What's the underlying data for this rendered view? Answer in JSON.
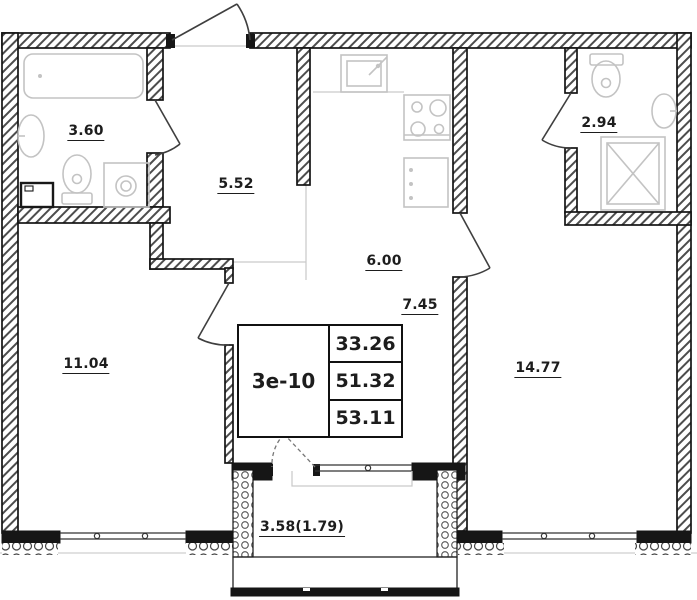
{
  "title": "Apartment floor plan",
  "unit": {
    "code": "3е-10",
    "living_area": "33.26",
    "total_area": "51.32",
    "total_area_with_balcony": "53.11"
  },
  "rooms": {
    "bathroom_top_left": {
      "area": "3.60"
    },
    "hallway": {
      "area": "5.52"
    },
    "bathroom_top_right": {
      "area": "2.94"
    },
    "kitchen": {
      "area": "6.00"
    },
    "corridor": {
      "area": "7.45"
    },
    "room_left": {
      "area": "11.04"
    },
    "room_right": {
      "area": "14.77"
    },
    "balcony": {
      "area": "3.58(1.79)"
    }
  },
  "fixtures": {
    "bathroom_top_left": [
      "bathtub-icon",
      "washbasin-icon",
      "toilet-icon",
      "washing-machine-icon",
      "appliance-zone-icon"
    ],
    "kitchen": [
      "kitchen-sink-icon",
      "stove-icon",
      "base-cabinet-icon"
    ],
    "bathroom_top_right": [
      "toilet-icon",
      "washbasin-icon",
      "shower-icon"
    ]
  },
  "colors": {
    "background": "#ffffff",
    "wall_hatch": "#4d4d4d",
    "wall_outline": "#141414",
    "solid_wall": "#161616",
    "fixture_line": "#c3c3c3",
    "zone_line": "#c9c9c9",
    "door_line": "#3f3f3f",
    "text": "#1d1d1d"
  }
}
